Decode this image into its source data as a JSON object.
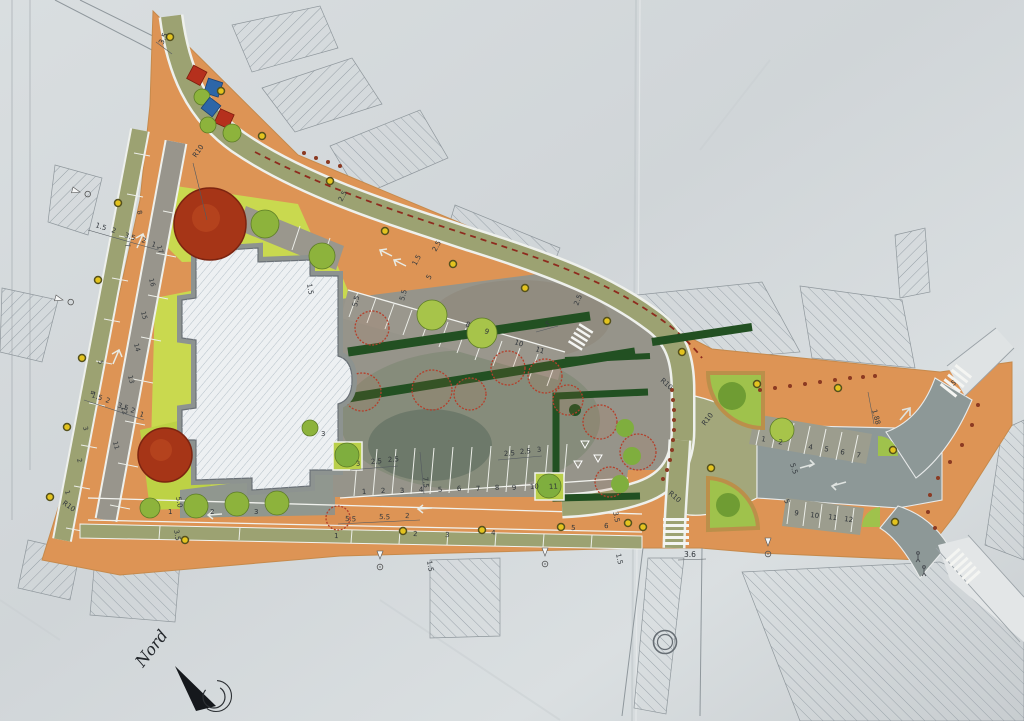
{
  "document": {
    "type": "photographed landscape / urban site plan drawing",
    "orientation_note": "plan sheet photographed with paper folds, hatched existing buildings, colored new design"
  },
  "north_arrow": {
    "label": "Nord"
  },
  "colors": {
    "paper": "#d5dadc",
    "pavement_orange": "#dd9455",
    "road_olive": "#9ca272",
    "road_gray": "#8d9897",
    "parking_gray": "#96948a",
    "lawn_green": "#c9d94f",
    "hedge_dark": "#225022",
    "tree_green": "#8db33c",
    "tree_red": "#a63517",
    "equipment_blue": "#2d66a8",
    "equipment_red": "#b5301d",
    "shrub_outline_red": "#b4402c",
    "lamp_yellow": "#e3c31e",
    "bike_dash_red": "#8e2b1e"
  },
  "dims": {
    "top_path_width": "3.5",
    "north": [
      "2.5",
      "2.5",
      "5",
      "1.5",
      "5.5",
      "2.5"
    ],
    "left_upper": [
      "1.5",
      "2",
      "3.5",
      "2",
      "1"
    ],
    "left_lower": [
      "1.5",
      "2",
      "3.5",
      "2",
      "1"
    ],
    "south": [
      "5.5",
      "5.5",
      "2"
    ],
    "central_left": [
      "3",
      "2.5",
      "2.5"
    ],
    "central_right": [
      "2.5",
      "2.5",
      "3"
    ],
    "aisle": "7.5",
    "stall_depth": "5.5",
    "cw_top": "5",
    "cw_ne": "5",
    "south_cross": "3.6",
    "south_path": "3.5",
    "verge": "1.5",
    "walk": "1.5",
    "lawn": "1.5",
    "right_offset": "1.88",
    "right_depth": "5.5",
    "right_aisle": "5",
    "radius": "R10",
    "tree_sp": [
      "5.0",
      "3.5"
    ],
    "tree_note": "3"
  },
  "stalls": {
    "central": [
      "1",
      "2",
      "3",
      "4",
      "5",
      "6",
      "7",
      "8",
      "9",
      "10",
      "11"
    ],
    "top": [
      "8",
      "9",
      "10",
      "11"
    ],
    "right_upper": [
      "1",
      "2",
      "4",
      "5",
      "6",
      "7"
    ],
    "right_lower": [
      "9",
      "10",
      "11",
      "12"
    ],
    "left_outer": [
      "1",
      "2",
      "3",
      "4",
      "5",
      "7",
      "8"
    ],
    "left_inner": [
      "11",
      "12",
      "13",
      "14",
      "15",
      "16",
      "17"
    ],
    "verge": [
      "1",
      "2",
      "3",
      "4",
      "5",
      "6"
    ],
    "trees": [
      "1",
      "2",
      "3"
    ]
  }
}
